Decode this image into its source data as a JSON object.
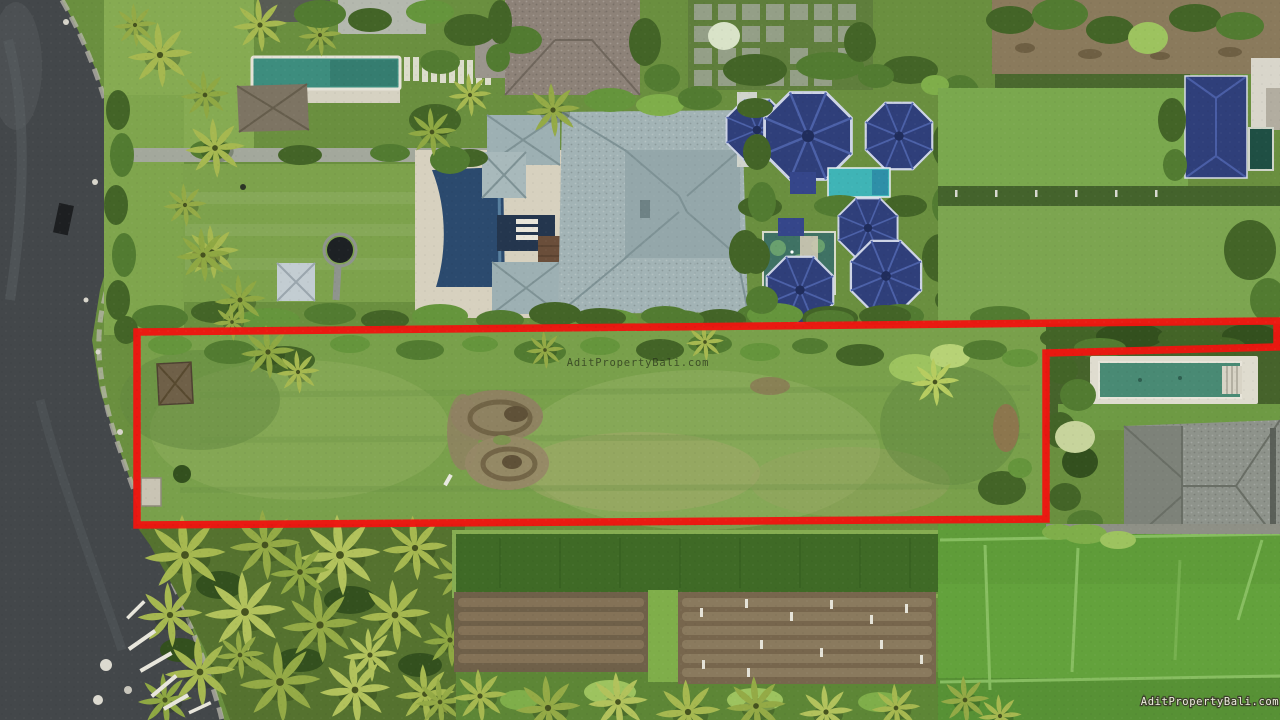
{
  "photo": {
    "kind": "aerial-drone-photograph",
    "subject": "Beachfront vacant land plot outlined in red between luxury villas, a black-sand beach, garden beds and rice paddies"
  },
  "watermarks": {
    "center": "AditPropertyBali.com",
    "bottom_right": "AditPropertyBali.com"
  },
  "boundary": {
    "color": "#ee1510",
    "stroke_width": 7.5
  },
  "palette": {
    "beach_sand": "#43474a",
    "foam": "#b9b7ae",
    "lawn": "#7da24c",
    "plot_grass": "#79a04b",
    "hedge": "#436427",
    "roof_gray_blue": "#a2b3b5",
    "roof_taupe": "#8d8278",
    "roof_blue": "#2f3f7a",
    "roof_thatch_gray": "#8e938b",
    "pool_left_villa": "#3d8d7e",
    "pool_center_villa": "#2b4a6e",
    "pool_turquoise": "#3fb4b6",
    "pond_green": "#3f7264",
    "pool_right_villa": "#498a74",
    "soil_beds": "#77664d",
    "crop_field": "#3f6a26",
    "rice_paddy": "#63a23c",
    "palm_frond": "#a6b850"
  }
}
